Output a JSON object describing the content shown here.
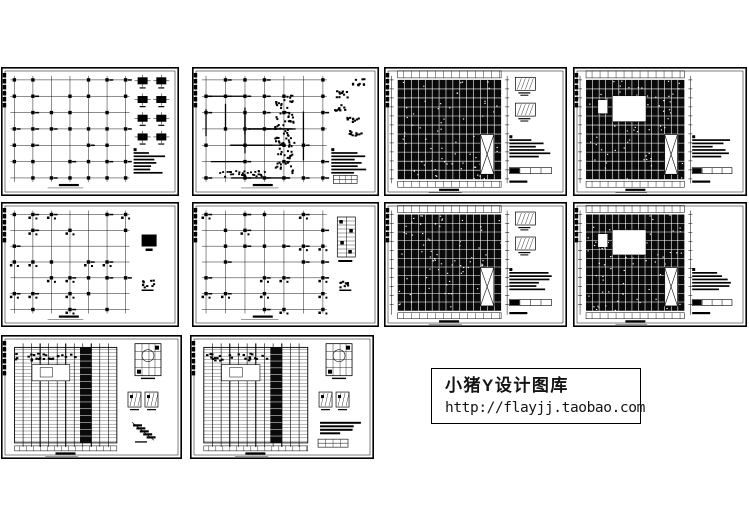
{
  "colors": {
    "background": "#ffffff",
    "ink": "#000000",
    "dense_fill": "#0a0a0a"
  },
  "watermark": {
    "x": 431,
    "y": 368,
    "w": 210,
    "h": 56,
    "line1": "小猪Y设计图库",
    "line2": "http://flayjj.taobao.com"
  },
  "gallery": {
    "items": [
      {
        "id": "sheet-1",
        "x": 1,
        "y": 67,
        "w": 178,
        "h": 129,
        "style": "columns",
        "details": [
          "colgrid",
          "notes"
        ],
        "seed": 11
      },
      {
        "id": "sheet-2",
        "x": 192,
        "y": 67,
        "w": 187,
        "h": 129,
        "style": "beams",
        "details": [
          "blobs",
          "notes",
          "smalltable"
        ],
        "seed": 22
      },
      {
        "id": "sheet-3",
        "x": 384,
        "y": 67,
        "w": 183,
        "h": 129,
        "style": "dense",
        "details": [
          "sections",
          "notes",
          "table"
        ],
        "seed": 33
      },
      {
        "id": "sheet-4",
        "x": 573,
        "y": 67,
        "w": 174,
        "h": 129,
        "style": "dense-hole",
        "details": [
          "notes",
          "table"
        ],
        "seed": 44
      },
      {
        "id": "sheet-5",
        "x": 1,
        "y": 202,
        "w": 178,
        "h": 125,
        "style": "columns-sparse",
        "details": [
          "square",
          "blob"
        ],
        "seed": 55
      },
      {
        "id": "sheet-6",
        "x": 192,
        "y": 202,
        "w": 187,
        "h": 125,
        "style": "columns-sparse",
        "details": [
          "ladder",
          "blob"
        ],
        "seed": 66
      },
      {
        "id": "sheet-7",
        "x": 384,
        "y": 202,
        "w": 183,
        "h": 125,
        "style": "dense",
        "details": [
          "sections",
          "notes",
          "table"
        ],
        "seed": 77
      },
      {
        "id": "sheet-8",
        "x": 573,
        "y": 202,
        "w": 174,
        "h": 125,
        "style": "dense-hole",
        "details": [
          "notes",
          "table"
        ],
        "seed": 88
      },
      {
        "id": "sheet-9",
        "x": 1,
        "y": 335,
        "w": 181,
        "h": 124,
        "style": "hatch",
        "details": [
          "bigbox",
          "twoboxes",
          "stair"
        ],
        "seed": 99
      },
      {
        "id": "sheet-10",
        "x": 190,
        "y": 335,
        "w": 184,
        "h": 124,
        "style": "hatch",
        "details": [
          "bigbox",
          "twoboxes",
          "notesbars",
          "smalltable"
        ],
        "seed": 110
      }
    ]
  }
}
